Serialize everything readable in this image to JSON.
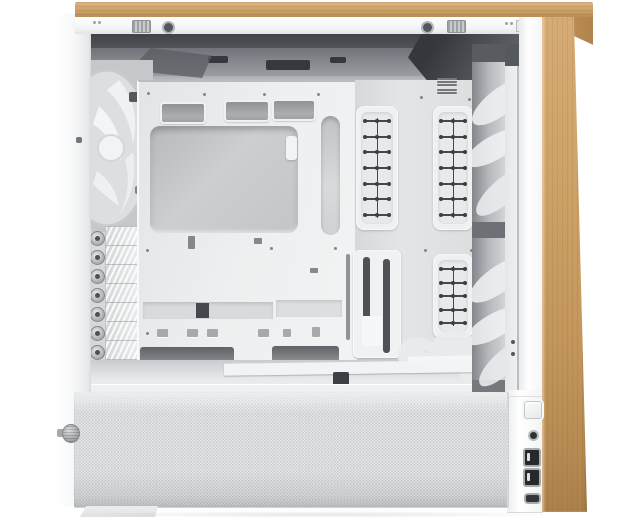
{
  "meta": {
    "description": "Product photo of a white mid-tower PC case with a light oak wood front panel and wood top trim; the side panel is removed showing an empty white interior with motherboard tray, CPU cooler cutout, cable grommets, cable-tie rails, rear fan, seven PCI slot covers with thumbscrews, front intake fans and a perforated PSU shroud mesh",
    "background_color": "#ffffff"
  },
  "colors": {
    "case_white": "#f4f5f6",
    "interior_gray": "#d6d8da",
    "interior_dark_top": "#45484d",
    "wood_light": "#d8b17c",
    "wood_dark": "#b1834c",
    "mesh_base": "#edeff0",
    "ladder_marks": "#44474b",
    "port_dark": "#26292c"
  },
  "case": {
    "wood_trim": {
      "locations": [
        "top-edge",
        "front-panel"
      ]
    },
    "rear": {
      "fan_count": 1,
      "pci_slots": {
        "count": 7,
        "thumbscrews": 7
      }
    },
    "motherboard_tray": {
      "cable_grommets": 3,
      "cpu_cutout": 1,
      "bottom_cable_slots": 2
    },
    "cable_rails": {
      "panels": [
        {
          "rungs": 7
        },
        {
          "rungs": 7
        },
        {
          "rungs": 5
        }
      ]
    },
    "front": {
      "visible_fans": 2
    },
    "front_io": {
      "ports": [
        {
          "type": "power",
          "label": "power-button"
        },
        {
          "type": "audio",
          "label": "audio-jack"
        },
        {
          "type": "usb-a",
          "label": "usb-a-port-1"
        },
        {
          "type": "usb-a",
          "label": "usb-a-port-2"
        },
        {
          "type": "usb-c",
          "label": "usb-c-port"
        }
      ]
    },
    "psu_shroud": {
      "mesh": true,
      "thumbscrew": 1
    }
  }
}
